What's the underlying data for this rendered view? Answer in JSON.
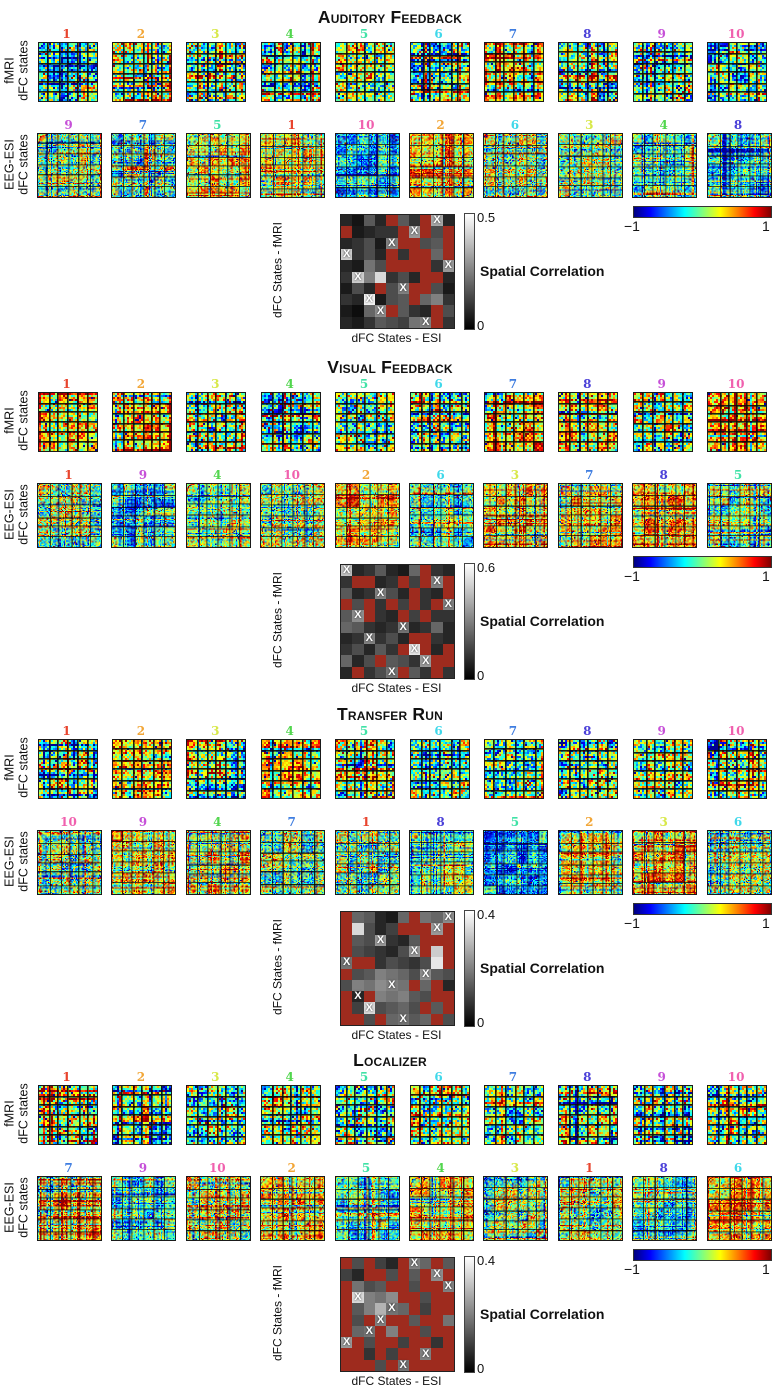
{
  "chart_data": {
    "type": "heatmap",
    "colormap": "jet",
    "figure_kind": "dFC state matrices with fMRI-ESI spatial correlation",
    "row_labels": {
      "fmri": [
        "fMRI",
        "dFC states"
      ],
      "eeg": [
        "EEG-ESI",
        "dFC states"
      ]
    },
    "state_colors": {
      "1": "#e8442e",
      "2": "#f2a637",
      "3": "#d8e84a",
      "4": "#52d64e",
      "5": "#3fe2a6",
      "6": "#3fd8ea",
      "7": "#3f7de0",
      "8": "#4a3fd8",
      "9": "#c650d8",
      "10": "#f060ae"
    },
    "matrix_colorbar": {
      "min": -1,
      "max": 1,
      "min_label": "−1",
      "max_label": "1"
    },
    "correlation": {
      "xlabel": "dFC States - ESI",
      "ylabel": "dFC States - fMRI",
      "colorbar_label": "Spatial Correlation",
      "min_label": "0",
      "x_mark": "X",
      "masked_color": "#9e2b1e"
    },
    "sections": [
      {
        "title": "Auditory Feedback",
        "fmri_states": [
          1,
          2,
          3,
          4,
          5,
          6,
          7,
          8,
          9,
          10
        ],
        "fmri_tints": [
          "mixed",
          "mixed",
          "mixed",
          "mixed",
          "mixed",
          "mixed",
          "warm",
          "mixed",
          "mixed",
          "mixed"
        ],
        "eeg_states": [
          9,
          7,
          5,
          1,
          10,
          2,
          6,
          3,
          4,
          8
        ],
        "eeg_tints": [
          "mixed",
          "mixed",
          "warm",
          "warm",
          "blue",
          "red",
          "mixed",
          "mixed",
          "green",
          "cool"
        ],
        "corr_max_label": "0.5",
        "corr_matches": [
          9,
          7,
          5,
          1,
          10,
          2,
          6,
          3,
          4,
          8
        ],
        "corr_cells": [
          [
            0.15,
            0.08,
            0.35,
            0.15,
            "R",
            0.35,
            0.2,
            "R",
            0.65,
            0.15
          ],
          [
            "R",
            0.1,
            0.15,
            0.2,
            0.2,
            "R",
            0.6,
            "R",
            0.3,
            "R"
          ],
          [
            0.15,
            0.2,
            0.3,
            0.1,
            0.5,
            "R",
            "R",
            0.3,
            0.35,
            "R"
          ],
          [
            0.8,
            0.2,
            0.3,
            0.15,
            "R",
            0.2,
            "R",
            "R",
            0.4,
            "R"
          ],
          [
            0.15,
            0.1,
            0.45,
            0.3,
            "R",
            "R",
            "R",
            "R",
            0.2,
            0.6
          ],
          [
            0.2,
            0.8,
            0.5,
            0.85,
            0.2,
            0.3,
            0.15,
            "R",
            "R",
            0.15
          ],
          [
            0.1,
            0.3,
            0.15,
            "R",
            0.3,
            0.5,
            "R",
            "R",
            0.3,
            0.1
          ],
          [
            0.2,
            0.15,
            0.95,
            0.1,
            0.3,
            0.35,
            "R",
            0.4,
            0.5,
            0.2
          ],
          [
            0.1,
            0.05,
            0.4,
            0.55,
            "R",
            0.35,
            0.2,
            0.15,
            "R",
            0.3
          ],
          [
            0.15,
            0.1,
            0.2,
            0.35,
            0.3,
            0.25,
            0.45,
            0.5,
            "R",
            0.2
          ]
        ]
      },
      {
        "title": "Visual Feedback",
        "fmri_states": [
          1,
          2,
          3,
          4,
          5,
          6,
          7,
          8,
          9,
          10
        ],
        "fmri_tints": [
          "warm",
          "warm",
          "mixed",
          "mixed",
          "mixed",
          "mixed",
          "warm",
          "warm",
          "mixed",
          "warm"
        ],
        "eeg_states": [
          1,
          9,
          4,
          10,
          2,
          6,
          3,
          7,
          8,
          5
        ],
        "eeg_tints": [
          "mixed",
          "cool",
          "green",
          "mixed",
          "warm",
          "cool",
          "warm",
          "warm",
          "red",
          "green"
        ],
        "corr_max_label": "0.6",
        "corr_matches": [
          1,
          9,
          4,
          10,
          2,
          6,
          3,
          7,
          8,
          5
        ],
        "corr_cells": [
          [
            0.75,
            0.15,
            0.2,
            0.35,
            0.15,
            0.1,
            0.4,
            "R",
            0.2,
            0.15
          ],
          [
            0.2,
            "R",
            "R",
            0.15,
            0.2,
            "R",
            0.25,
            "R",
            0.5,
            "R"
          ],
          [
            0.35,
            0.15,
            0.2,
            0.5,
            0.3,
            0.15,
            "R",
            0.2,
            0.15,
            "R"
          ],
          [
            "R",
            0.3,
            "R",
            0.2,
            "R",
            0.25,
            "R",
            0.2,
            "R",
            0.5
          ],
          [
            0.35,
            0.55,
            "R",
            0.2,
            0.15,
            "R",
            0.25,
            "R",
            0.2,
            0.2
          ],
          [
            0.4,
            0.35,
            0.2,
            0.15,
            0.2,
            0.45,
            0.15,
            0.2,
            0.4,
            0.15
          ],
          [
            0.15,
            0.2,
            0.5,
            0.2,
            0.3,
            0.15,
            "R",
            "R",
            0.2,
            0.15
          ],
          [
            0.2,
            0.3,
            0.15,
            0.35,
            0.2,
            "R",
            0.9,
            "R",
            0.15,
            "R"
          ],
          [
            0.4,
            0.15,
            0.3,
            "R",
            0.35,
            0.3,
            0.2,
            0.6,
            "R",
            "R"
          ],
          [
            0.15,
            "R",
            0.2,
            0.3,
            0.45,
            "R",
            0.35,
            0.2,
            "R",
            0.2
          ]
        ]
      },
      {
        "title": "Transfer Run",
        "fmri_states": [
          1,
          2,
          3,
          4,
          5,
          6,
          7,
          8,
          9,
          10
        ],
        "fmri_tints": [
          "mixed",
          "warm",
          "mixed",
          "warm",
          "mixed",
          "mixed",
          "mixed",
          "mixed",
          "mixed",
          "mixed"
        ],
        "eeg_states": [
          10,
          9,
          4,
          7,
          1,
          8,
          5,
          2,
          3,
          6
        ],
        "eeg_tints": [
          "mixed",
          "warm",
          "warm",
          "mixed",
          "mixed",
          "green",
          "blue",
          "warm",
          "warm",
          "mixed"
        ],
        "corr_max_label": "0.4",
        "corr_matches": [
          10,
          9,
          4,
          7,
          1,
          8,
          5,
          2,
          3,
          6
        ],
        "corr_cells": [
          [
            "R",
            0.4,
            0.35,
            0.15,
            0.1,
            0.4,
            "R",
            0.45,
            0.4,
            0.55
          ],
          [
            "R",
            0.85,
            0.3,
            0.15,
            0.25,
            "R",
            "R",
            "R",
            0.6,
            "R"
          ],
          [
            "R",
            0.35,
            0.3,
            0.6,
            0.2,
            0.15,
            0.35,
            "R",
            "R",
            "R"
          ],
          [
            "R",
            0.3,
            0.25,
            0.2,
            0.15,
            0.3,
            0.6,
            "R",
            0.8,
            "R"
          ],
          [
            0.45,
            "R",
            "R",
            0.2,
            0.3,
            0.25,
            0.2,
            0.3,
            0.9,
            "R"
          ],
          [
            "R",
            0.3,
            0.35,
            0.5,
            0.45,
            0.4,
            0.3,
            0.55,
            0.35,
            0.3
          ],
          [
            0.3,
            0.5,
            0.45,
            0.55,
            0.5,
            0.45,
            "R",
            0.4,
            "R",
            0.15
          ],
          [
            "R",
            0.15,
            "R",
            0.5,
            0.45,
            0.5,
            0.35,
            0.3,
            "R",
            "R"
          ],
          [
            "R",
            0.25,
            0.85,
            0.3,
            0.35,
            0.4,
            0.3,
            "R",
            0.35,
            "R"
          ],
          [
            "R",
            "R",
            0.3,
            "R",
            0.4,
            0.45,
            0.35,
            0.4,
            "R",
            0.3
          ]
        ]
      },
      {
        "title": "Localizer",
        "fmri_states": [
          1,
          2,
          3,
          4,
          5,
          6,
          7,
          8,
          9,
          10
        ],
        "fmri_tints": [
          "mixed",
          "cool",
          "mixed",
          "mixed",
          "mixed",
          "mixed",
          "mixed",
          "mixed",
          "mixed",
          "mixed"
        ],
        "eeg_states": [
          7,
          9,
          10,
          2,
          5,
          4,
          3,
          1,
          8,
          6
        ],
        "eeg_tints": [
          "warm",
          "cool",
          "mixed",
          "warm",
          "cool",
          "warm",
          "mixed",
          "mixed",
          "cool",
          "red"
        ],
        "corr_max_label": "0.4",
        "corr_matches": [
          7,
          9,
          10,
          2,
          5,
          4,
          3,
          1,
          8,
          6
        ],
        "corr_cells": [
          [
            "R",
            0.3,
            "R",
            0.25,
            0.15,
            "R",
            0.5,
            0.4,
            "R",
            0.35
          ],
          [
            0.25,
            0.15,
            "R",
            "R",
            0.3,
            "R",
            0.35,
            "R",
            0.55,
            "R"
          ],
          [
            "R",
            0.45,
            0.3,
            0.35,
            "R",
            "R",
            0.3,
            "R",
            "R",
            0.5
          ],
          [
            "R",
            0.85,
            0.5,
            0.45,
            0.55,
            "R",
            "R",
            0.3,
            "R",
            "R"
          ],
          [
            "R",
            0.35,
            0.5,
            0.7,
            0.45,
            0.4,
            "R",
            0.25,
            "R",
            "R"
          ],
          [
            "R",
            0.3,
            "R",
            0.5,
            "R",
            "R",
            0.35,
            "R",
            "R",
            0.45
          ],
          [
            "R",
            0.4,
            0.45,
            "R",
            0.5,
            "R",
            "R",
            0.3,
            "R",
            "R"
          ],
          [
            0.6,
            "R",
            0.3,
            "R",
            "R",
            0.25,
            "R",
            "R",
            0.2,
            "R"
          ],
          [
            "R",
            "R",
            0.2,
            "R",
            0.25,
            "R",
            "R",
            0.5,
            "R",
            "R"
          ],
          [
            "R",
            "R",
            "R",
            0.3,
            "R",
            0.45,
            "R",
            "R",
            "R",
            "R"
          ]
        ]
      }
    ]
  }
}
